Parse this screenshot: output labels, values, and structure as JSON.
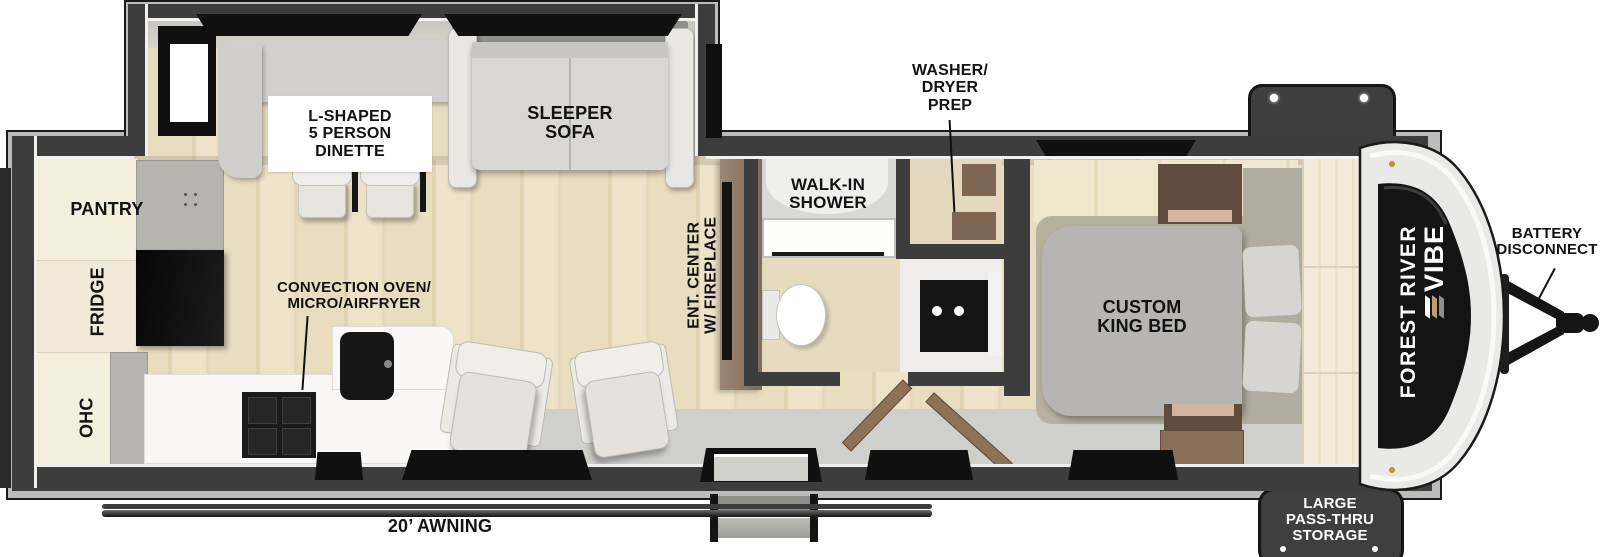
{
  "page_title": "Forest River Vibe Travel Trailer Floorplan",
  "brand": {
    "manufacturer": "FOREST RIVER",
    "model": "VIBE"
  },
  "labels": {
    "dinette": "L-SHAPED\n5 PERSON\nDINETTE",
    "sleeper_sofa": "SLEEPER\nSOFA",
    "pantry": "PANTRY",
    "fridge": "FRIDGE",
    "ohc": "OHC",
    "convection_oven": "CONVECTION OVEN/\nMICRO/AIRFRYER",
    "ent_center": "ENT. CENTER\nW/ FIREPLACE",
    "walk_in_shower": "WALK-IN\nSHOWER",
    "washer_dryer_prep": "WASHER/\nDRYER\nPREP",
    "king_bed": "CUSTOM\nKING BED",
    "battery_disconnect": "BATTERY\nDISCONNECT",
    "pass_thru_storage": "LARGE\nPASS-THRU\nSTORAGE",
    "awning": "20’ AWNING"
  },
  "colors": {
    "wall": "#3d3d3d",
    "outer_band": "#bcbcba",
    "floor_wood": "#e9ddc0",
    "landing_gray": "#cfcfcb",
    "cabinet_cream": "#f4eedd",
    "cabinet_gray": "#b6b4af",
    "counter_white": "#f9f8f6",
    "appliance_black": "#111111",
    "sofa_gray": "#d8d7d4",
    "bed_gray": "#b6b5b3",
    "wood_brown": "#8d7866",
    "cap_white": "#e9e9e7",
    "windshield_black": "#141414",
    "badge_dark": "#3f3f3f",
    "badge_text": "#ffffff",
    "label_text": "#121212"
  }
}
